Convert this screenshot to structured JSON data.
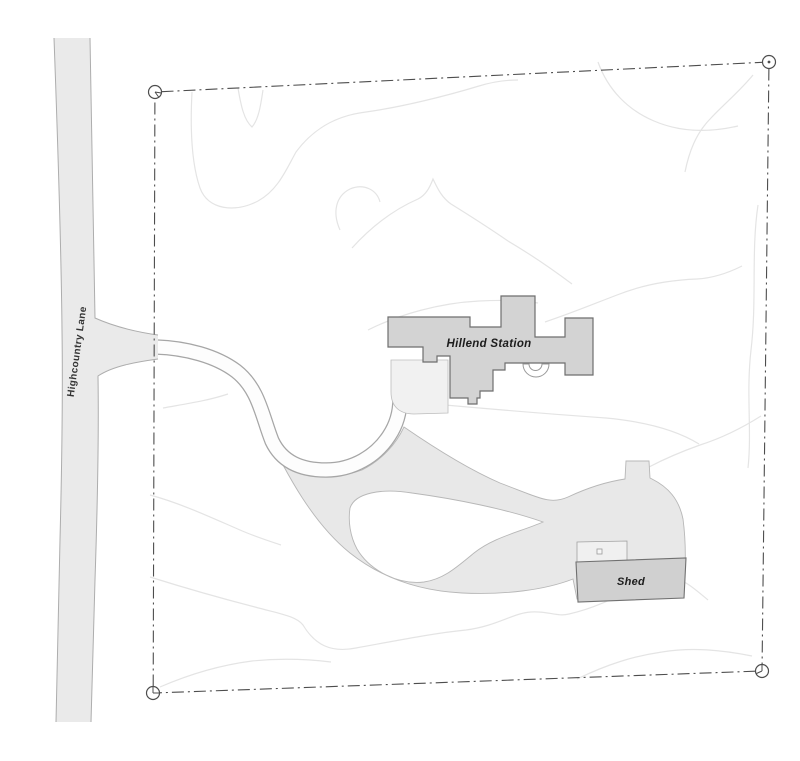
{
  "labels": {
    "road": "Highcountry Lane",
    "main_building": "Hillend Station",
    "shed": "Shed"
  },
  "colors": {
    "background": "#ffffff",
    "road_fill": "#eaeaea",
    "driveway_fill": "#fdfdfd",
    "track_fill": "#e8e8e8",
    "building_fill": "#d3d3d3",
    "shed_fill": "#d0d0d0",
    "pad_fill": "#f0f0f0",
    "courtyard_fill": "#f1f1f1",
    "contour_stroke": "#e4e4e4",
    "boundary_stroke": "#4d4d4d",
    "building_stroke": "#6e6e6e"
  }
}
